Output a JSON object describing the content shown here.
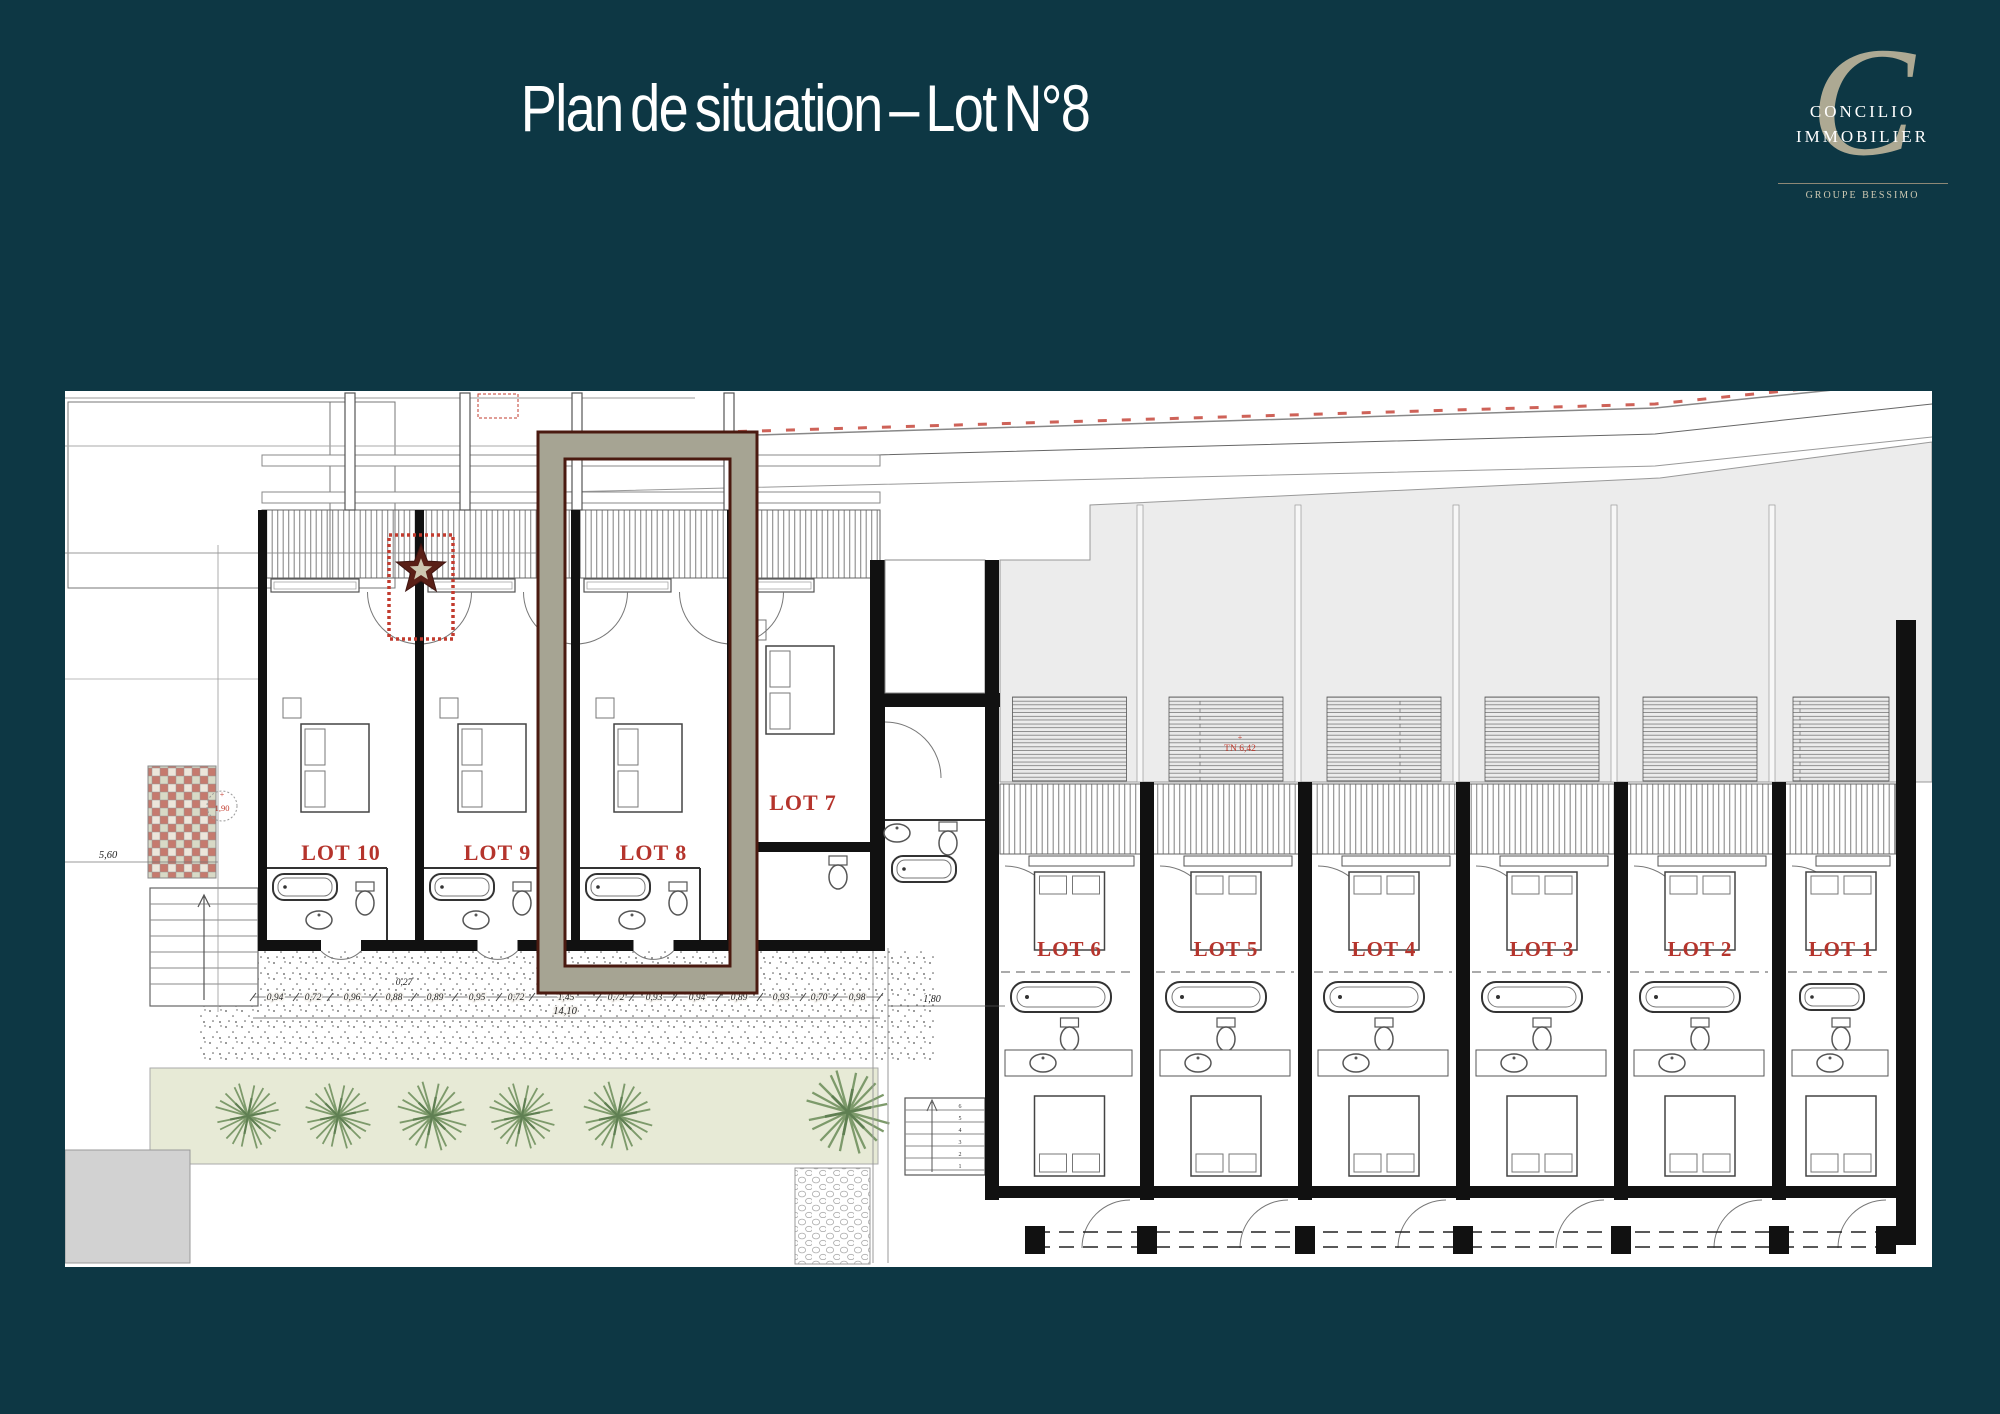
{
  "slide": {
    "background": "#0d3744",
    "title": "Plan de situation – Lot N°8"
  },
  "logo": {
    "monogram": "C",
    "name_line1": "CONCILIO",
    "name_line2": "IMMOBILIER",
    "group": "GROUPE BESSIMO"
  },
  "plan": {
    "highlighted_lot": "LOT 8",
    "left_building_lots": [
      {
        "label": "LOT 10"
      },
      {
        "label": "LOT 9"
      },
      {
        "label": "LOT 8"
      },
      {
        "label": "LOT 7"
      }
    ],
    "right_building_lots": [
      {
        "label": "LOT 6"
      },
      {
        "label": "LOT 5"
      },
      {
        "label": "LOT 4"
      },
      {
        "label": "LOT 3"
      },
      {
        "label": "LOT 2"
      },
      {
        "label": "LOT 1"
      }
    ],
    "dimensions": {
      "chain": [
        "0,94",
        "0,72",
        "0,96",
        "0,88",
        "0,89",
        "0,95",
        "0,72",
        "1,45",
        "0,72",
        "0,93",
        "0,94",
        "0,89",
        "0,93",
        "0,70",
        "0,98"
      ],
      "chain_extra": "0,27",
      "chain_total": "14,10",
      "gap_right": "1,80",
      "left_offset": "5,60",
      "spot_elevation": "1,90",
      "terrain_level": "TN 6,42"
    },
    "stair_steps": [
      "1",
      "2",
      "3",
      "4",
      "5",
      "6"
    ],
    "colors": {
      "highlight_fill": "#a6a493",
      "highlight_border": "#4a1a10",
      "lot_label_red": "#b5342c",
      "marker_red": "#c23b2e",
      "star_fill": "#5a2017"
    }
  }
}
